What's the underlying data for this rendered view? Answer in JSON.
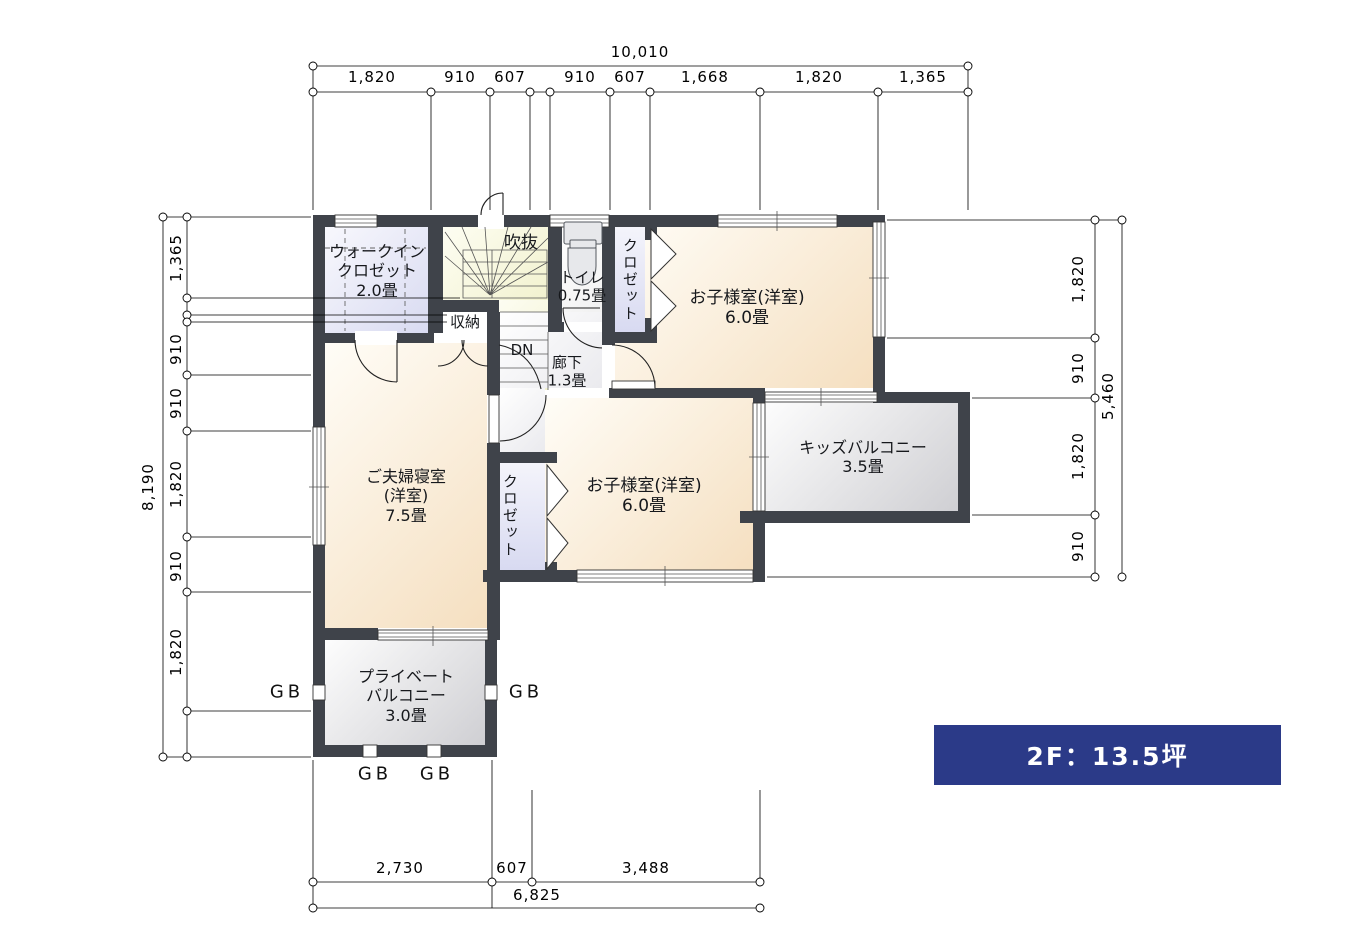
{
  "floor_plan": {
    "rooms": {
      "walk_in_closet": {
        "name_line1": "ウォークイン",
        "name_line2": "クロゼット",
        "size": "2.0畳"
      },
      "void_space": {
        "name": "吹抜"
      },
      "toilet": {
        "name": "トイレ",
        "size": "0.75畳"
      },
      "closet_kids1": {
        "name": "クロゼット"
      },
      "kids_room_1": {
        "name": "お子様室(洋室)",
        "size": "6.0畳"
      },
      "storage": {
        "name": "収納"
      },
      "stairs": {
        "direction": "DN"
      },
      "hallway": {
        "name": "廊下",
        "size": "1.3畳"
      },
      "master_bedroom": {
        "name_line1": "ご夫婦寝室",
        "name_line2": "(洋室)",
        "size": "7.5畳"
      },
      "closet_kids2": {
        "name": "クロゼット"
      },
      "kids_room_2": {
        "name": "お子様室(洋室)",
        "size": "6.0畳"
      },
      "kids_balcony": {
        "name": "キッズバルコニー",
        "size": "3.5畳"
      },
      "private_balcony": {
        "name_line1": "プライベート",
        "name_line2": "バルコニー",
        "size": "3.0畳"
      }
    },
    "dimensions": {
      "top": {
        "total": "10,010",
        "segments": [
          "1,820",
          "910",
          "607",
          "910",
          "607",
          "1,668",
          "1,820",
          "1,365"
        ]
      },
      "left": {
        "total": "8,190",
        "segments": [
          "1,365",
          "910",
          "910",
          "1,820",
          "910",
          "1,820"
        ]
      },
      "right": {
        "total": "5,460",
        "segments": [
          "1,820",
          "910",
          "1,820",
          "910"
        ]
      },
      "bottom": {
        "total": "6,825",
        "segments": [
          "2,730",
          "607",
          "3,488"
        ]
      }
    },
    "gb_labels": [
      "GB",
      "GB",
      "GB",
      "GB"
    ],
    "summary": {
      "label": "2F：13.5坪",
      "bg_color": "#2b3a88"
    },
    "icons": {
      "toilet": "toilet-fixture-icon"
    },
    "colors": {
      "wall": "#3f434a",
      "room_cream": "#f5dfc0",
      "closet_lavender": "#d8daf1",
      "stair_yellow": "#f2f2cf",
      "balcony_gray": "#cfcfd3",
      "accent_blue": "#2b3a88"
    }
  }
}
